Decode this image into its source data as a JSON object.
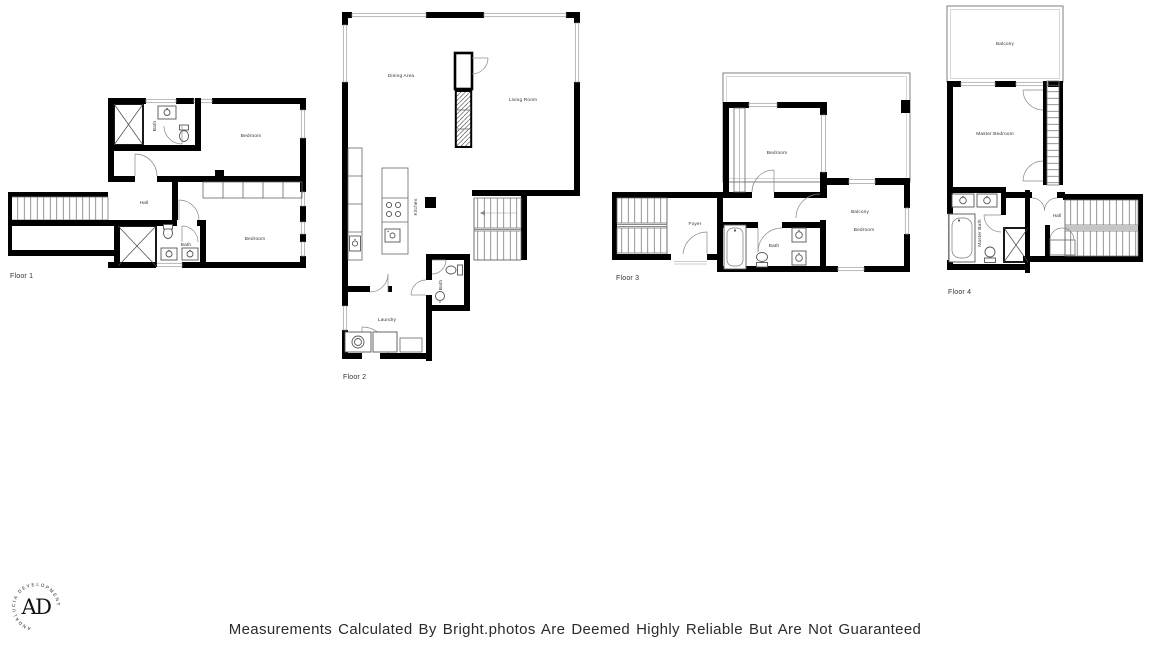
{
  "disclaimer": "Measurements Calculated By Bright.photos Are Deemed Highly Reliable But Are Not Guaranteed",
  "logo": {
    "ring_text": "ANDALUCIA DEVELOPMENT",
    "monogram": "AD"
  },
  "floors": [
    {
      "label": "Floor 1",
      "rooms": {
        "bedroom_top": "Bedroom",
        "hall": "Hall",
        "bath_upper": "Bath",
        "bath_lower": "Bath",
        "bedroom_bottom": "Bedroom"
      }
    },
    {
      "label": "Floor 2",
      "rooms": {
        "dining": "Dining Area",
        "living": "Living Room",
        "kitchen": "Kitchen",
        "bath": "Bath",
        "laundry": "Laundry"
      }
    },
    {
      "label": "Floor 3",
      "rooms": {
        "bedroom_top": "Bedroom",
        "balcony": "Balcony",
        "foyer": "Foyer",
        "bath": "Bath",
        "bedroom_right": "Bedroom"
      }
    },
    {
      "label": "Floor 4",
      "rooms": {
        "balcony": "Balcony",
        "master_bedroom": "Master Bedroom",
        "master_bath": "Master Bath",
        "hall": "Hall"
      }
    }
  ],
  "colors": {
    "wall": "#000000",
    "thin_line": "#666666",
    "window": "#9a9a9a",
    "label": "#333333",
    "text": "#2b2b2b",
    "background": "#ffffff"
  }
}
